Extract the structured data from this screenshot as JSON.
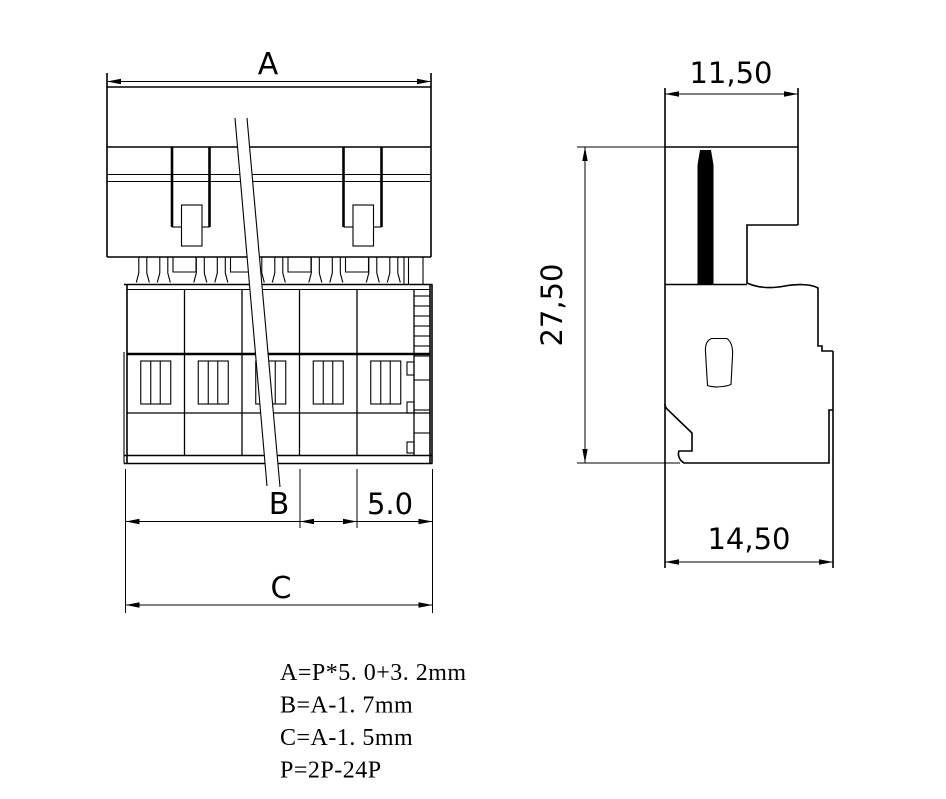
{
  "page": {
    "background_color": "#ffffff",
    "line_color": "#000000"
  },
  "front_view": {
    "dim_a": "A",
    "dim_b": "B",
    "dim_pitch": "5.0",
    "dim_c": "C"
  },
  "side_view": {
    "dim_top_width": "11,50",
    "dim_height": "27,50",
    "dim_bottom_width": "14,50"
  },
  "notes": {
    "line1": "A=P*5. 0+3. 2mm",
    "line2": "B=A-1. 7mm",
    "line3": "C=A-1. 5mm",
    "line4": "P=2P-24P"
  }
}
